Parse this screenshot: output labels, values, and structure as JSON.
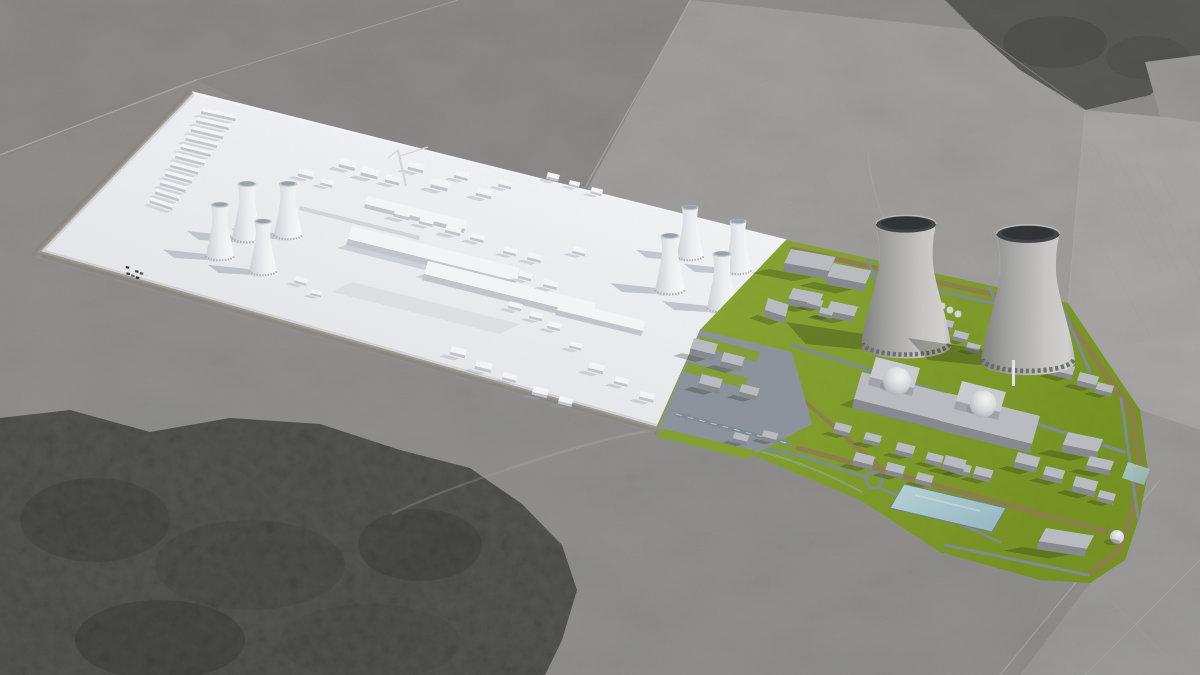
{
  "scene": {
    "title": "Aerial 3D visualization of a nuclear power plant site: white concept massing model beside a detailed landscaped plant model over grayscale aerial photography"
  },
  "counts": {
    "white_model_cooling_towers": 8,
    "detailed_model_cooling_towers": 2,
    "reactor_domes": 2,
    "white_model_bar_buildings": 11
  },
  "palette": {
    "photo-base": "#8f8e8c",
    "photo-field-dark": "#8a8988",
    "photo-field-light": "#a3a2a0",
    "photo-field-lighter": "#aaa9a7",
    "forest": "#525250",
    "boundary": "#b5b4b2",
    "model-white": "#f5f6f8",
    "model-side": "#c3c6cc",
    "model-shadow": "#98a0ae",
    "bldg-top": "#b9bdc2",
    "bldg-side": "#868a90",
    "site-green": "#84a02c",
    "road-gray": "#7d8a95",
    "road-tan": "#8d7b4f",
    "apron": "#8b929b",
    "tower-rim": "#3f4244",
    "water-light": "#b9d2d6",
    "water-deep": "#93b7c4"
  }
}
